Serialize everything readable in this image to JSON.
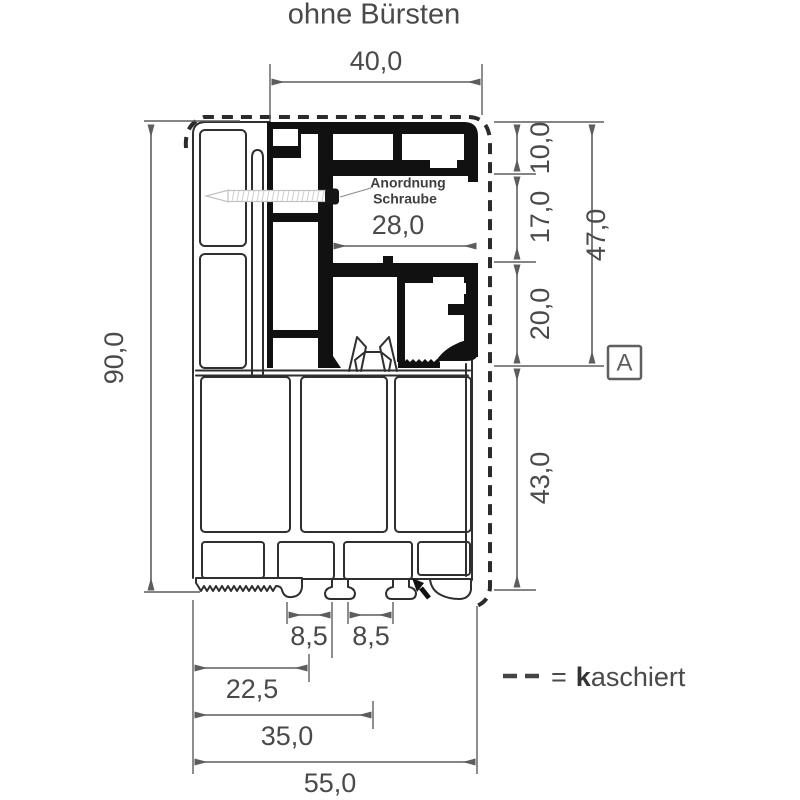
{
  "title": "ohne Bürsten",
  "annotations": {
    "screw_line1": "Anordnung",
    "screw_line2": "Schraube",
    "section_marker": "A"
  },
  "dims": {
    "top": "40,0",
    "inner": "28,0",
    "height": "90,0",
    "r10": "10,0",
    "r17": "17,0",
    "r20": "20,0",
    "r43": "43,0",
    "r47": "47,0",
    "gap1": "8,5",
    "gap2": "8,5",
    "b225": "22,5",
    "b35": "35,0",
    "b55": "55,0"
  },
  "legend": {
    "dash_symbol": "- -",
    "eq": "=",
    "k": "k",
    "rest": "aschiert"
  },
  "colors": {
    "profile_line": "#2f2f2f",
    "profile_fill": "#111111",
    "dim": "#5d5d5d",
    "text": "#4a4a4a",
    "dashed": "#2b2b2b",
    "screw": "#c2c2c2"
  }
}
